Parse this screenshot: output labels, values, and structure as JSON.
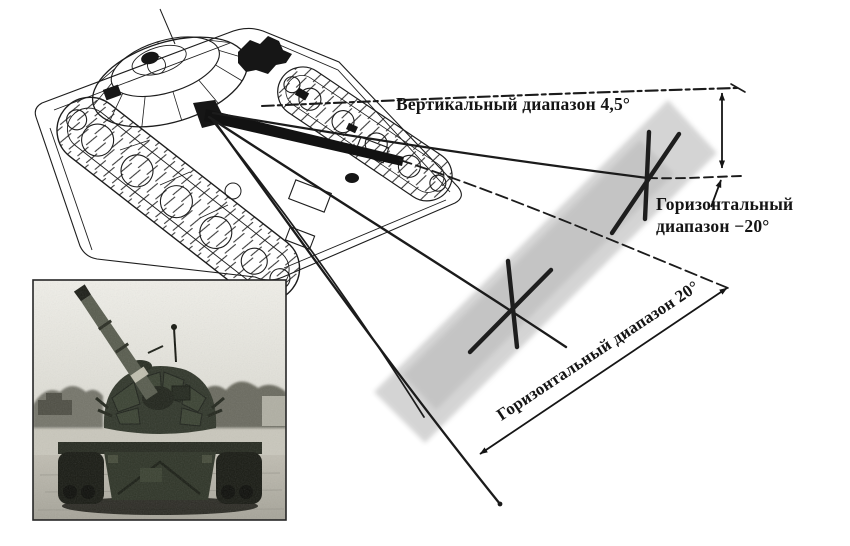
{
  "diagram": {
    "labels": {
      "vertical_range": "Вертикальный диапазон 4,5°",
      "horizontal_near_1": "Горизонтальный",
      "horizontal_near_2": "диапазон −20°",
      "horizontal_far": "Горизонтальный диапазон 20°"
    },
    "colors": {
      "ink": "#1b1b1b",
      "target_plane": "#c9c9c9",
      "photo_sky": "#eeede8",
      "photo_ground": "#b4b1a6",
      "photo_tank": "#30362a"
    }
  }
}
